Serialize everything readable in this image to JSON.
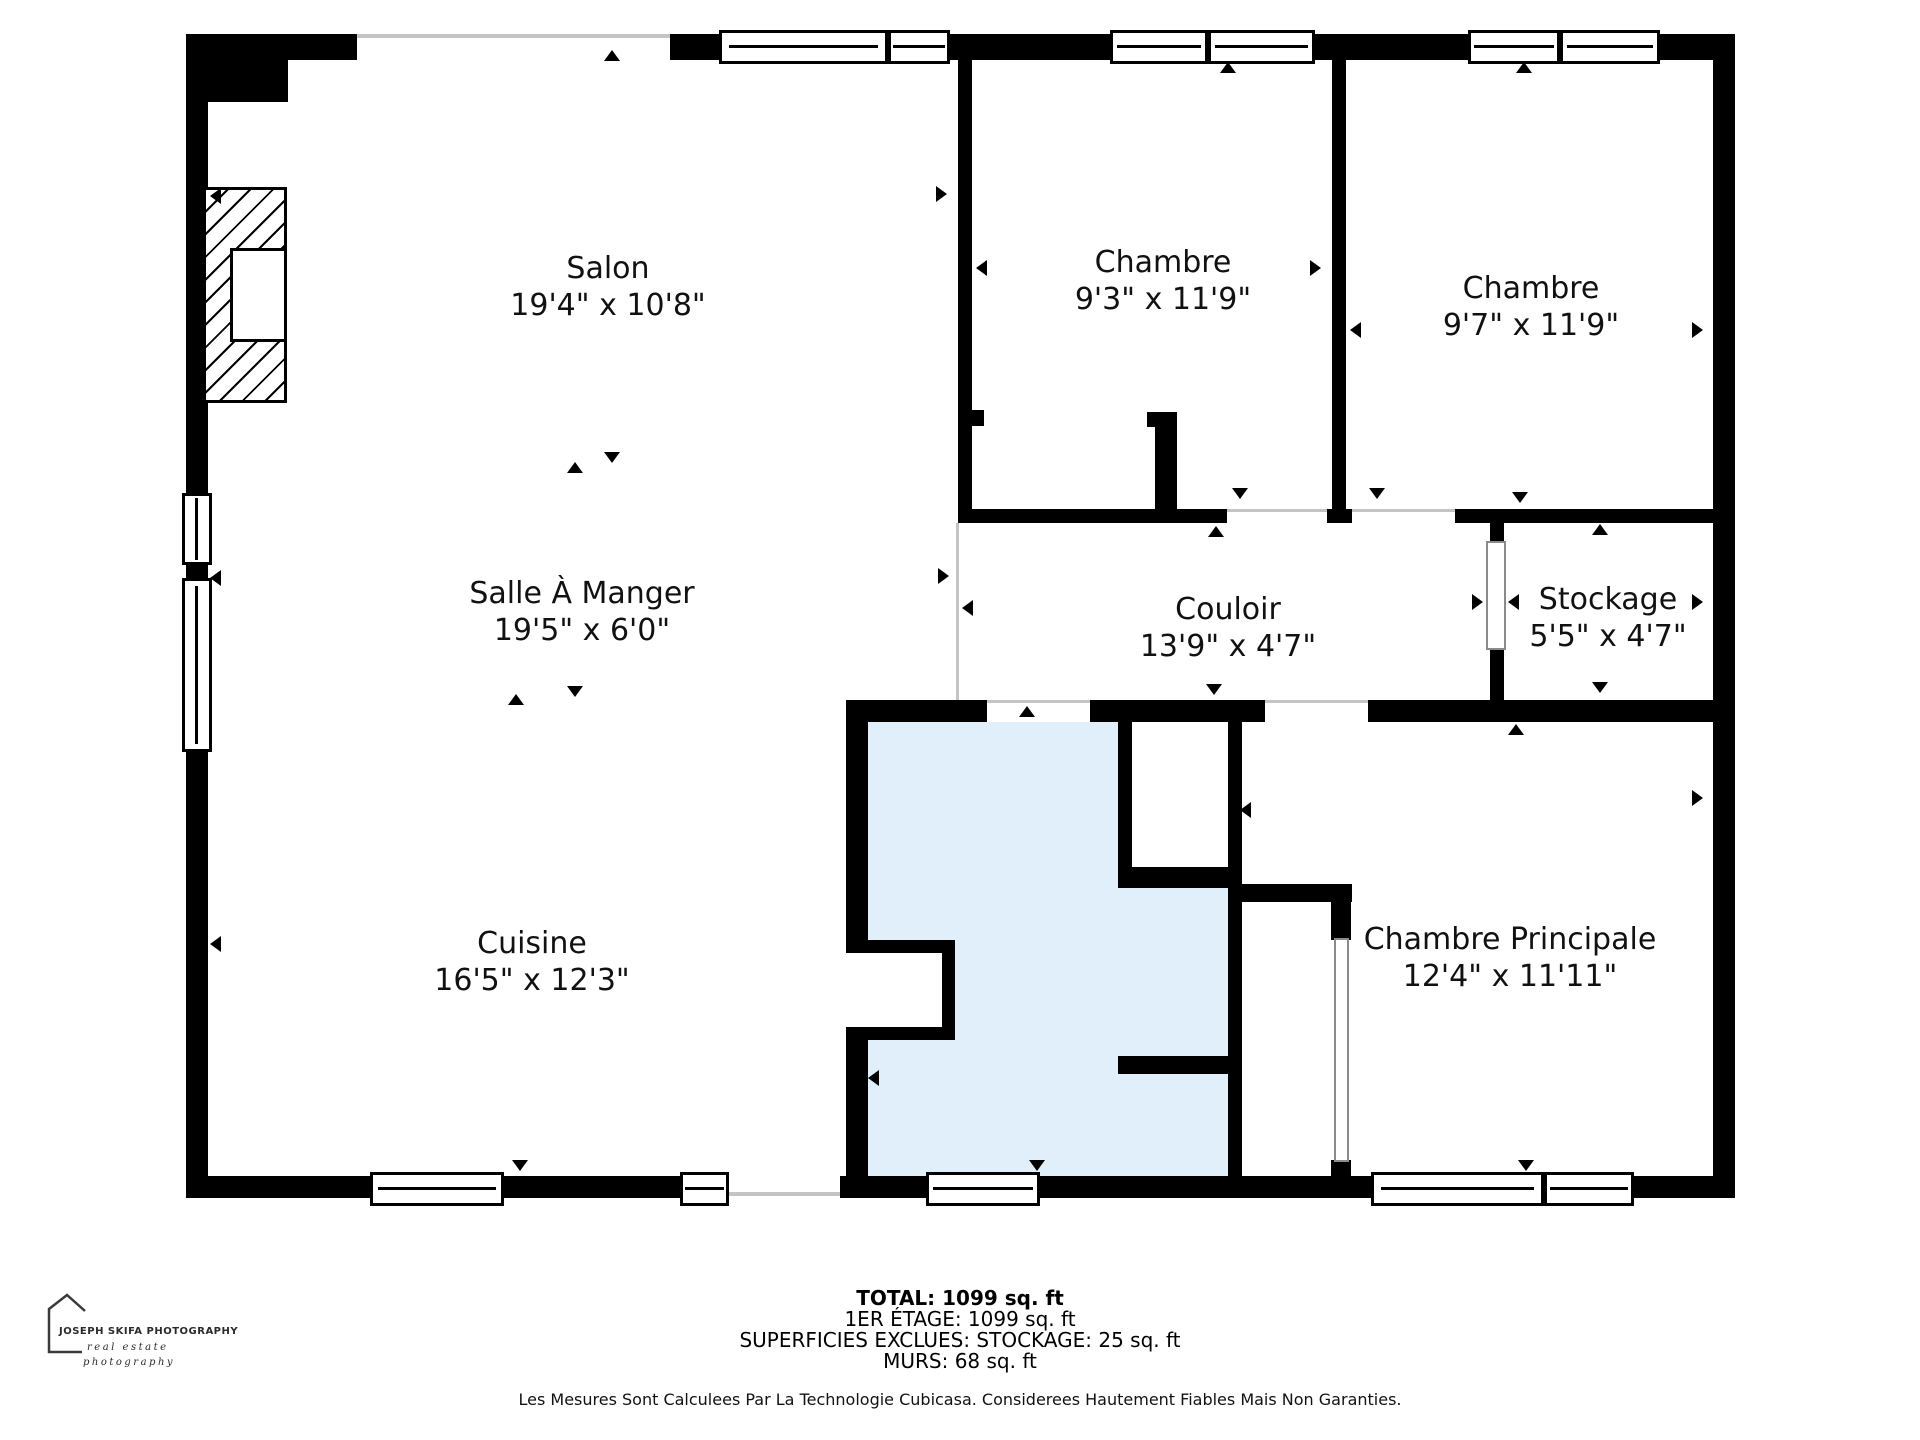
{
  "rooms": {
    "salon": {
      "name": "Salon",
      "dims": "19'4\" x 10'8\""
    },
    "chambre1": {
      "name": "Chambre",
      "dims": "9'3\" x 11'9\""
    },
    "chambre2": {
      "name": "Chambre",
      "dims": "9'7\" x 11'9\""
    },
    "salle_a_manger": {
      "name": "Salle À Manger",
      "dims": "19'5\" x 6'0\""
    },
    "couloir": {
      "name": "Couloir",
      "dims": "13'9\" x 4'7\""
    },
    "stockage": {
      "name": "Stockage",
      "dims": "5'5\" x 4'7\""
    },
    "cuisine": {
      "name": "Cuisine",
      "dims": "16'5\" x 12'3\""
    },
    "salle_de_bain": {
      "name": "Salle De Bain",
      "dims": "9'4\" x 11'11\""
    },
    "chambre_principale": {
      "name": "Chambre Principale",
      "dims": "12'4\" x 11'11\""
    }
  },
  "footer": {
    "total": "TOTAL: 1099 sq. ft",
    "etage": "1ER ÉTAGE: 1099 sq. ft",
    "exclusions": "SUPERFICIES EXCLUES: STOCKAGE: 25 sq. ft",
    "murs": "MURS: 68 sq. ft",
    "disclaimer": "Les Mesures Sont Calculees Par La Technologie Cubicasa. Considerees Hautement Fiables Mais Non Garanties."
  },
  "logo": {
    "title": "JOSEPH SKIFA PHOTOGRAPHY",
    "sub1": "real estate",
    "sub2": "photography"
  },
  "colors": {
    "wall": "#000000",
    "bathroom_fill": "#E0EFFA",
    "open_line": "#c4c4c4"
  }
}
